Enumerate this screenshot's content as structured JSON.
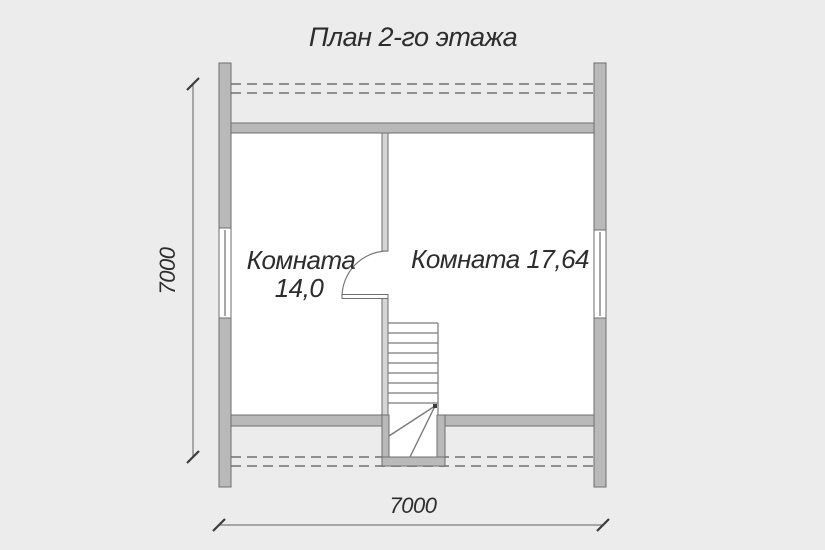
{
  "title": "План 2-го этажа",
  "floor_plan": {
    "rooms": [
      {
        "label_lines": [
          "Комната",
          "14,0"
        ]
      },
      {
        "label_lines": [
          "Комната 17,64"
        ]
      }
    ],
    "dimensions": {
      "horizontal": "7000",
      "vertical": "7000"
    }
  },
  "colors": {
    "background": "#ececec",
    "room_fill": "#ffffff",
    "wall_fill": "#b9b9b9",
    "partition_fill": "#d6d6d6",
    "wall_stroke": "#6e6e6e",
    "dash": "#8f8f8f",
    "stair_line": "#7a7a7a",
    "dim": "#5f5f5f",
    "tick": "#3c3c3c",
    "text": "#2d2d2d"
  }
}
